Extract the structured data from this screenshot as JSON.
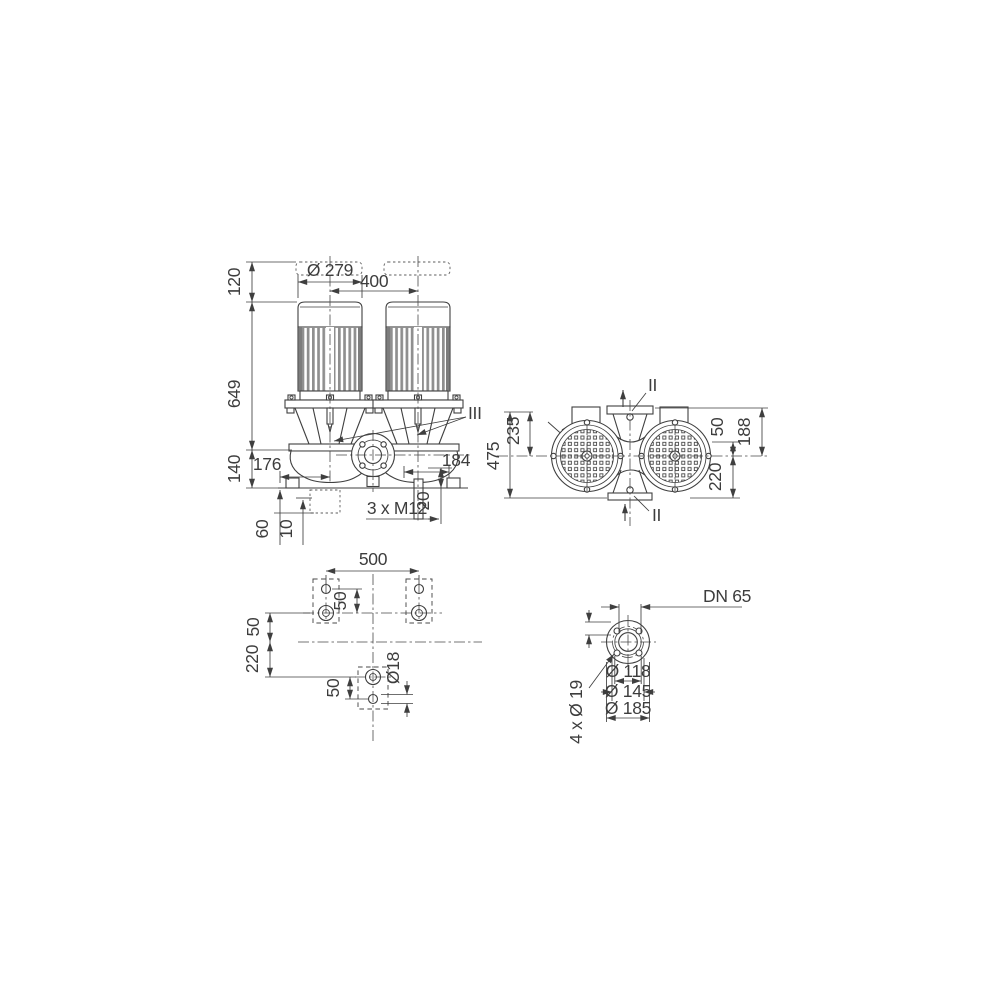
{
  "page": {
    "background": "#ffffff",
    "line_color": "#3f3f3f"
  },
  "front_view": {
    "clearance_above_motor": "120",
    "motor_diameter": "Ø 279",
    "motor_spacing": "400",
    "unit_height": "649",
    "base_height": "140",
    "left_offset": "176",
    "right_offset": "184",
    "drain_length": "20",
    "fixing_thread": "3 x M12",
    "foundation_depth": "60",
    "grout_height": "10",
    "detail_mark": "III"
  },
  "top_view": {
    "port_to_port": "475",
    "axis_to_flange": "235",
    "axis_offset": "50",
    "flange_to_axis": "188",
    "axis_to_port": "220",
    "section_mark_top": "II",
    "section_mark_bottom": "II"
  },
  "foundation_view": {
    "bolt_spacing": "500",
    "pad_hole_pitch_top": "50",
    "axis_to_bolt_row": "50",
    "row_spacing": "220",
    "pad_hole_pitch_bottom": "50",
    "anchor_hole_diameter": "Ø18"
  },
  "flange_view": {
    "nominal_diameter": "DN 65",
    "raised_face_diameter": "Ø 118",
    "bolt_circle_diameter": "Ø 145",
    "flange_outer_diameter": "Ø 185",
    "bolt_holes": "4 x Ø 19"
  }
}
